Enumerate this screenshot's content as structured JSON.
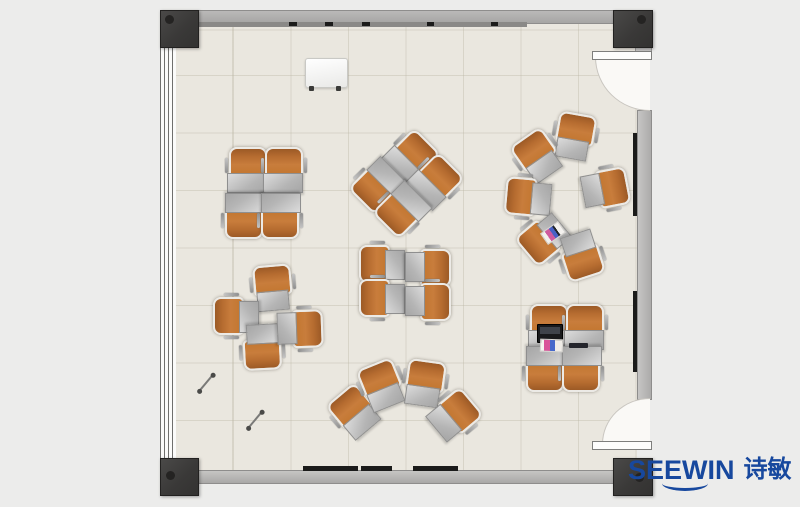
{
  "brand": {
    "name_en": "SEEWIN",
    "name_zh": "诗敏",
    "logo_color": "#17489e"
  },
  "palette": {
    "chair_orange": "#c87d3c",
    "desk_gray": "#c3c3c3",
    "floor": "#eae7df",
    "wall_gray": "#b0afae",
    "column_dark": "#3c3b3a",
    "background": "#ececeb"
  },
  "floorplan": {
    "description": "classroom training-room top view with desk-chair clusters",
    "units": [
      {
        "x": 246,
        "y": 170,
        "r": 0
      },
      {
        "x": 282,
        "y": 170,
        "r": 0
      },
      {
        "x": 246,
        "y": 216,
        "r": 180
      },
      {
        "x": 282,
        "y": 216,
        "r": 180
      },
      {
        "x": 409.5,
        "y": 155.5,
        "r": 45
      },
      {
        "x": 433.5,
        "y": 179.5,
        "r": 45
      },
      {
        "x": 378.5,
        "y": 186.5,
        "r": 225
      },
      {
        "x": 402.5,
        "y": 210.5,
        "r": 225
      },
      {
        "x": 573,
        "y": 136,
        "r": 10,
        "dw": 30
      },
      {
        "x": 536,
        "y": 157,
        "r": -35,
        "dw": 30
      },
      {
        "x": 528,
        "y": 199,
        "r": -85,
        "dw": 30
      },
      {
        "x": 545,
        "y": 240,
        "r": -130,
        "dw": 30
      },
      {
        "x": 583,
        "y": 255,
        "r": 162,
        "dw": 30
      },
      {
        "x": 605,
        "y": 187,
        "r": 79,
        "dw": 30
      },
      {
        "x": 271,
        "y": 288,
        "r": -5,
        "dw": 30
      },
      {
        "x": 236,
        "y": 318,
        "r": -90,
        "dw": 30
      },
      {
        "x": 264,
        "y": 347,
        "r": 177,
        "dw": 30
      },
      {
        "x": 300,
        "y": 327,
        "r": 88,
        "dw": 30
      },
      {
        "x": 382,
        "y": 266,
        "r": -90,
        "dw": 28
      },
      {
        "x": 382,
        "y": 300,
        "r": -90,
        "dw": 28
      },
      {
        "x": 428,
        "y": 266,
        "r": 90,
        "dw": 28
      },
      {
        "x": 428,
        "y": 300,
        "r": 90,
        "dw": 28
      },
      {
        "x": 353,
        "y": 413,
        "r": -40,
        "dw": 32
      },
      {
        "x": 380,
        "y": 386,
        "r": -22,
        "dw": 32
      },
      {
        "x": 423,
        "y": 383,
        "r": 8,
        "dw": 32
      },
      {
        "x": 453,
        "y": 414,
        "r": 50,
        "dw": 32
      },
      {
        "x": 547,
        "y": 327,
        "r": 0
      },
      {
        "x": 583,
        "y": 327,
        "r": 0
      },
      {
        "x": 547,
        "y": 369,
        "r": 180
      },
      {
        "x": 583,
        "y": 369,
        "r": 180
      }
    ],
    "objects": [
      {
        "type": "easel",
        "name": "whiteboard-easel",
        "x": 325.5,
        "y": 72,
        "w": 41,
        "h": 28,
        "r": 0
      },
      {
        "type": "book-a",
        "name": "book",
        "x": 552,
        "y": 232,
        "w": 20,
        "h": 12,
        "r": -35
      },
      {
        "type": "laptop",
        "name": "laptop",
        "x": 549,
        "y": 332,
        "w": 24,
        "h": 17,
        "r": 0
      },
      {
        "type": "book-b",
        "name": "book",
        "x": 550,
        "y": 344,
        "w": 21,
        "h": 11,
        "r": 2
      },
      {
        "type": "tablet",
        "name": "tablet",
        "x": 578,
        "y": 345,
        "w": 19,
        "h": 5,
        "r": 0
      },
      {
        "type": "baton",
        "name": "pointer-stick",
        "x": 206,
        "y": 383,
        "w": 22,
        "h": 2,
        "r": -50
      },
      {
        "type": "baton",
        "name": "pointer-stick",
        "x": 255,
        "y": 420,
        "w": 22,
        "h": 2,
        "r": -50
      }
    ],
    "columns": [
      {
        "x": 160,
        "y": 10,
        "w": 37,
        "h": 36,
        "pos": "tl"
      },
      {
        "x": 613,
        "y": 10,
        "w": 38,
        "h": 36,
        "pos": "tr"
      },
      {
        "x": 160,
        "y": 458,
        "w": 37,
        "h": 36,
        "pos": "bl"
      },
      {
        "x": 613,
        "y": 458,
        "w": 38,
        "h": 36,
        "pos": "br"
      }
    ],
    "boards": [
      {
        "x": 633,
        "y": 133,
        "w": 4,
        "h": 83
      },
      {
        "x": 633,
        "y": 291,
        "w": 4,
        "h": 81
      },
      {
        "x": 303,
        "y": 466,
        "w": 55,
        "h": 5
      },
      {
        "x": 361,
        "y": 466,
        "w": 31,
        "h": 5
      },
      {
        "x": 413,
        "y": 466,
        "w": 45,
        "h": 5
      },
      {
        "x": 289,
        "y": 22,
        "w": 8,
        "h": 4
      },
      {
        "x": 325,
        "y": 22,
        "w": 8,
        "h": 4
      },
      {
        "x": 362,
        "y": 22,
        "w": 8,
        "h": 4
      },
      {
        "x": 427,
        "y": 22,
        "w": 7,
        "h": 4
      },
      {
        "x": 491,
        "y": 22,
        "w": 7,
        "h": 4
      }
    ]
  }
}
